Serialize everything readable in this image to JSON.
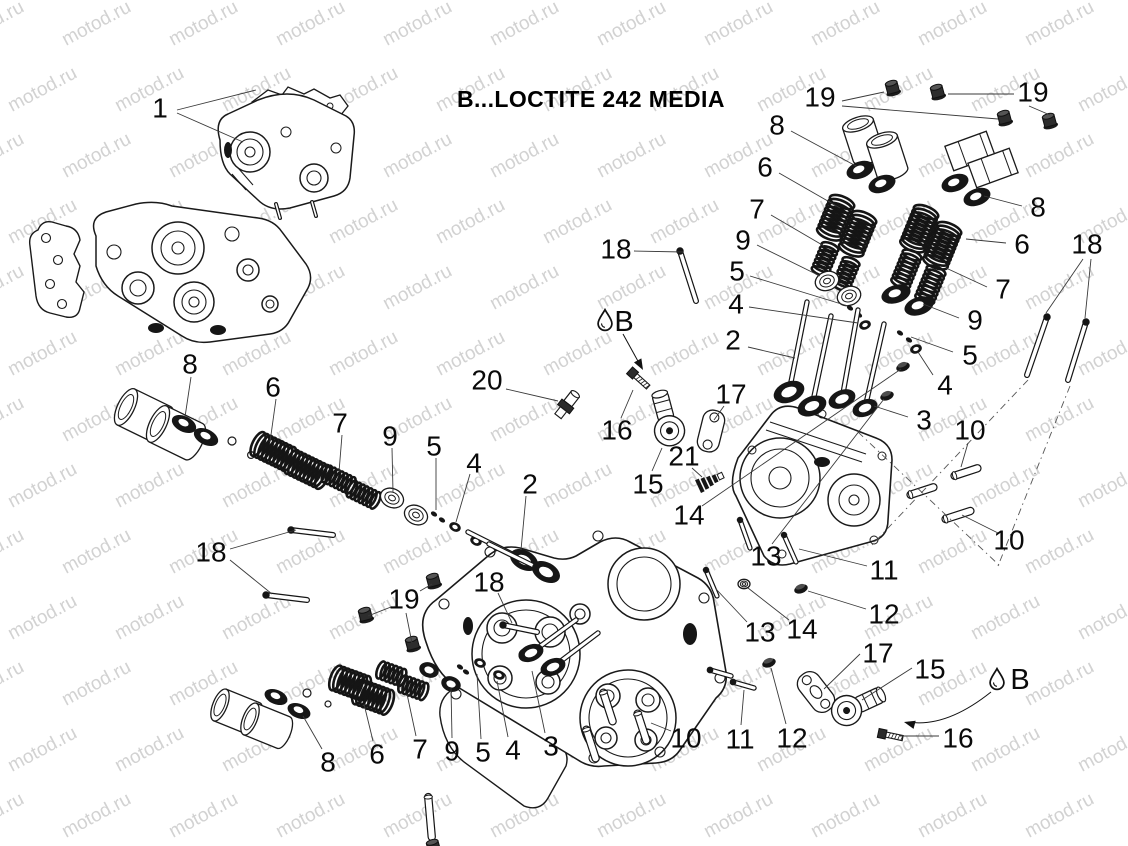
{
  "title": "B...LOCTITE 242 MEDIA",
  "watermark": {
    "text": "motod.ru",
    "color": "#d2d2d2"
  },
  "colors": {
    "line": "#1a1a1a",
    "leader": "#3a3a3a",
    "dark": "#161616"
  },
  "legend_symbols": [
    {
      "label": "B",
      "icon": "oil-drop-icon",
      "x": 624,
      "y": 322,
      "drop_x": 605,
      "drop_y": 320,
      "arrow": {
        "type": "straight",
        "x1": 623,
        "y1": 334,
        "x2": 639,
        "y2": 363
      }
    },
    {
      "label": "B",
      "icon": "oil-drop-icon",
      "x": 1020,
      "y": 680,
      "drop_x": 997,
      "drop_y": 679,
      "arrow": {
        "type": "curved",
        "path": "M 991 692 Q 946 728 908 722",
        "tip_x": 904,
        "tip_y": 722,
        "tip_deg": 195
      }
    }
  ],
  "callouts": [
    {
      "n": "1",
      "x": 160,
      "y": 108,
      "l": [
        [
          177,
          110,
          256,
          90
        ],
        [
          177,
          113,
          243,
          142
        ]
      ]
    },
    {
      "n": "19",
      "x": 820,
      "y": 97,
      "l": [
        [
          842,
          101,
          884,
          92
        ],
        [
          842,
          106,
          998,
          119
        ]
      ]
    },
    {
      "n": "19",
      "x": 1033,
      "y": 92,
      "l": [
        [
          1014,
          94,
          948,
          94
        ],
        [
          1029,
          106,
          1050,
          115
        ]
      ]
    },
    {
      "n": "8",
      "x": 777,
      "y": 125,
      "l": [
        [
          791,
          131,
          856,
          166
        ]
      ]
    },
    {
      "n": "6",
      "x": 765,
      "y": 167,
      "l": [
        [
          779,
          173,
          840,
          208
        ]
      ]
    },
    {
      "n": "7",
      "x": 757,
      "y": 209,
      "l": [
        [
          771,
          215,
          824,
          246
        ]
      ]
    },
    {
      "n": "18",
      "x": 616,
      "y": 249,
      "l": [
        [
          634,
          251,
          683,
          252
        ]
      ]
    },
    {
      "n": "9",
      "x": 743,
      "y": 240,
      "l": [
        [
          757,
          245,
          820,
          276
        ]
      ]
    },
    {
      "n": "5",
      "x": 737,
      "y": 271,
      "l": [
        [
          750,
          276,
          848,
          306
        ]
      ]
    },
    {
      "n": "4",
      "x": 736,
      "y": 304,
      "l": [
        [
          749,
          307,
          858,
          323
        ]
      ]
    },
    {
      "n": "2",
      "x": 733,
      "y": 340,
      "l": [
        [
          748,
          347,
          795,
          358
        ]
      ]
    },
    {
      "n": "8",
      "x": 1038,
      "y": 207,
      "l": [
        [
          1022,
          206,
          984,
          196
        ]
      ]
    },
    {
      "n": "6",
      "x": 1022,
      "y": 244,
      "l": [
        [
          1006,
          243,
          966,
          239
        ]
      ]
    },
    {
      "n": "18",
      "x": 1087,
      "y": 244,
      "l": [
        [
          1083,
          259,
          1046,
          313
        ],
        [
          1091,
          259,
          1085,
          318
        ]
      ]
    },
    {
      "n": "7",
      "x": 1003,
      "y": 289,
      "l": [
        [
          987,
          287,
          946,
          268
        ]
      ]
    },
    {
      "n": "9",
      "x": 975,
      "y": 320,
      "l": [
        [
          959,
          318,
          923,
          304
        ]
      ]
    },
    {
      "n": "5",
      "x": 970,
      "y": 355,
      "l": [
        [
          953,
          352,
          911,
          337
        ]
      ]
    },
    {
      "n": "4",
      "x": 945,
      "y": 385,
      "l": [
        [
          933,
          375,
          918,
          352
        ]
      ]
    },
    {
      "n": "3",
      "x": 924,
      "y": 420,
      "l": [
        [
          908,
          417,
          874,
          406
        ]
      ]
    },
    {
      "n": "8",
      "x": 190,
      "y": 364,
      "l": [
        [
          191,
          377,
          185,
          417
        ]
      ]
    },
    {
      "n": "6",
      "x": 273,
      "y": 387,
      "l": [
        [
          276,
          399,
          270,
          442
        ]
      ]
    },
    {
      "n": "20",
      "x": 487,
      "y": 380,
      "l": [
        [
          506,
          389,
          558,
          401
        ]
      ]
    },
    {
      "n": "16",
      "x": 617,
      "y": 430,
      "l": [
        [
          621,
          418,
          633,
          390
        ]
      ]
    },
    {
      "n": "17",
      "x": 731,
      "y": 394,
      "l": [
        [
          724,
          406,
          714,
          420
        ]
      ]
    },
    {
      "n": "7",
      "x": 340,
      "y": 423,
      "l": [
        [
          342,
          435,
          339,
          472
        ]
      ]
    },
    {
      "n": "9",
      "x": 390,
      "y": 436,
      "l": [
        [
          392,
          448,
          393,
          492
        ]
      ]
    },
    {
      "n": "5",
      "x": 434,
      "y": 446,
      "l": [
        [
          436,
          458,
          436,
          510
        ]
      ]
    },
    {
      "n": "4",
      "x": 474,
      "y": 463,
      "l": [
        [
          470,
          474,
          456,
          522
        ]
      ]
    },
    {
      "n": "2",
      "x": 530,
      "y": 484,
      "l": [
        [
          526,
          496,
          521,
          550
        ]
      ]
    },
    {
      "n": "15",
      "x": 648,
      "y": 484,
      "l": [
        [
          652,
          471,
          662,
          448
        ]
      ]
    },
    {
      "n": "21",
      "x": 684,
      "y": 456,
      "l": [
        [
          692,
          468,
          702,
          477
        ]
      ]
    },
    {
      "n": "10",
      "x": 970,
      "y": 430,
      "l": [
        [
          968,
          443,
          961,
          467
        ]
      ]
    },
    {
      "n": "14",
      "x": 689,
      "y": 515,
      "l": [
        [
          702,
          506,
          901,
          369
        ]
      ]
    },
    {
      "n": "13",
      "x": 766,
      "y": 556,
      "l": [
        [
          772,
          544,
          884,
          399
        ]
      ]
    },
    {
      "n": "18",
      "x": 211,
      "y": 552,
      "l": [
        [
          230,
          549,
          296,
          530
        ],
        [
          230,
          560,
          272,
          594
        ]
      ]
    },
    {
      "n": "11",
      "x": 884,
      "y": 570,
      "l": [
        [
          867,
          566,
          799,
          549
        ]
      ]
    },
    {
      "n": "10",
      "x": 1009,
      "y": 540,
      "l": [
        [
          998,
          533,
          962,
          515
        ]
      ]
    },
    {
      "n": "12",
      "x": 884,
      "y": 614,
      "l": [
        [
          866,
          609,
          808,
          591
        ]
      ]
    },
    {
      "n": "19",
      "x": 404,
      "y": 599,
      "l": [
        [
          420,
          591,
          432,
          584
        ],
        [
          391,
          607,
          368,
          616
        ],
        [
          406,
          613,
          412,
          643
        ]
      ]
    },
    {
      "n": "18",
      "x": 489,
      "y": 582,
      "l": [
        [
          498,
          593,
          512,
          623
        ]
      ]
    },
    {
      "n": "13",
      "x": 760,
      "y": 632,
      "l": [
        [
          747,
          622,
          716,
          589
        ]
      ]
    },
    {
      "n": "14",
      "x": 802,
      "y": 629,
      "l": [
        [
          789,
          620,
          748,
          588
        ]
      ]
    },
    {
      "n": "17",
      "x": 878,
      "y": 653,
      "l": [
        [
          860,
          654,
          824,
          689
        ]
      ]
    },
    {
      "n": "15",
      "x": 930,
      "y": 669,
      "l": [
        [
          912,
          668,
          862,
          700
        ]
      ]
    },
    {
      "n": "16",
      "x": 958,
      "y": 738,
      "l": [
        [
          939,
          736,
          900,
          736
        ]
      ]
    },
    {
      "n": "10",
      "x": 686,
      "y": 738,
      "l": [
        [
          671,
          731,
          651,
          723
        ]
      ]
    },
    {
      "n": "11",
      "x": 740,
      "y": 739,
      "l": [
        [
          741,
          725,
          744,
          690
        ]
      ]
    },
    {
      "n": "12",
      "x": 792,
      "y": 738,
      "l": [
        [
          786,
          724,
          771,
          668
        ]
      ]
    },
    {
      "n": "8",
      "x": 328,
      "y": 762,
      "l": [
        [
          322,
          749,
          303,
          716
        ]
      ]
    },
    {
      "n": "6",
      "x": 377,
      "y": 754,
      "l": [
        [
          373,
          741,
          364,
          704
        ]
      ]
    },
    {
      "n": "7",
      "x": 420,
      "y": 749,
      "l": [
        [
          416,
          736,
          407,
          694
        ]
      ]
    },
    {
      "n": "9",
      "x": 452,
      "y": 751,
      "l": [
        [
          452,
          738,
          451,
          688
        ]
      ]
    },
    {
      "n": "5",
      "x": 483,
      "y": 752,
      "l": [
        [
          481,
          739,
          477,
          674
        ]
      ]
    },
    {
      "n": "4",
      "x": 513,
      "y": 750,
      "l": [
        [
          508,
          737,
          497,
          681
        ]
      ]
    },
    {
      "n": "3",
      "x": 551,
      "y": 746,
      "l": [
        [
          545,
          733,
          532,
          671
        ]
      ]
    }
  ]
}
